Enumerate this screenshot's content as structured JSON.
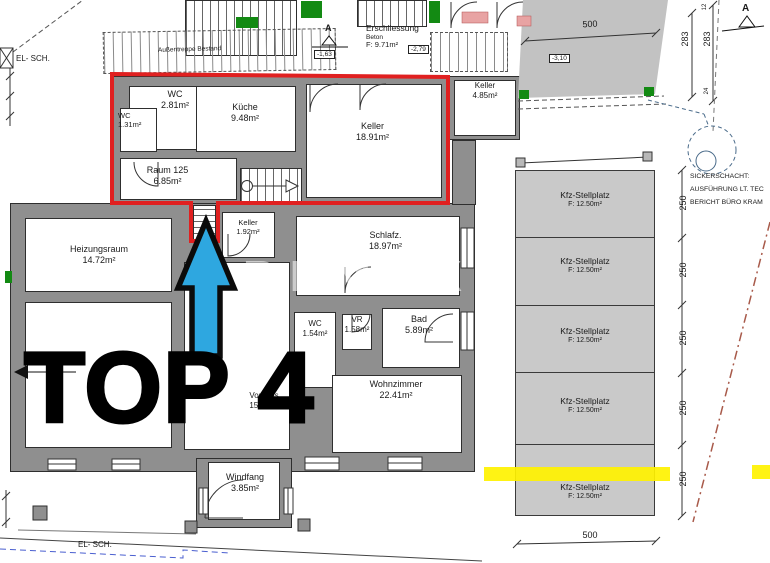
{
  "unit": {
    "label": "TOP 4"
  },
  "watermark": "REMAX",
  "rooms": [
    {
      "name": "WC",
      "area": "2.81m²"
    },
    {
      "name": "WC",
      "area": "1.31m²"
    },
    {
      "name": "Küche",
      "area": "9.48m²"
    },
    {
      "name": "Keller",
      "area": "18.91m²"
    },
    {
      "name": "Keller",
      "area": "4.85m²"
    },
    {
      "name": "Raum 125",
      "area": "6.85m²"
    },
    {
      "name": "Keller",
      "area": "1.92m²"
    },
    {
      "name": "Heizungsraum",
      "area": "14.72m²"
    },
    {
      "name": "Schlafz.",
      "area": "18.97m²"
    },
    {
      "name": "WC",
      "area": "1.54m²"
    },
    {
      "name": "VR",
      "area": "1.58m²"
    },
    {
      "name": "Bad",
      "area": "5.89m²"
    },
    {
      "name": "Wohnzimmer",
      "area": "22.41m²"
    },
    {
      "name": "Vorhaus",
      "area": "15.10m²"
    },
    {
      "name": "Windfang",
      "area": "3.85m²"
    }
  ],
  "parking": {
    "stall_label": "Kfz-Stellplatz",
    "stall_area": "F: 12.50m²"
  },
  "erschliessung": {
    "title": "Erschliessung",
    "material": "Beton",
    "area": "F: 9.71m²",
    "level_a": "-1,63",
    "level_b": "-2,79"
  },
  "stairs": {
    "outdoor": "Außentreppe Bestand"
  },
  "labels": {
    "el_sch": "EL- SCH.",
    "section_a": "A",
    "level_building": "-3,10"
  },
  "dims": {
    "w500": "500",
    "d283": "283",
    "d12": "12",
    "d24": "24",
    "d250": "250"
  },
  "sickerschacht": [
    "SICKERSCHACHT:",
    "AUSFÜHRUNG LT. TEC",
    "BERICHT BÜRO KRAM"
  ],
  "colors": {
    "outline": "#e02020",
    "arrow": "#2ea7e0",
    "highlight": "#fff200",
    "wall": "#8f8f8f",
    "green": "#138a13"
  }
}
